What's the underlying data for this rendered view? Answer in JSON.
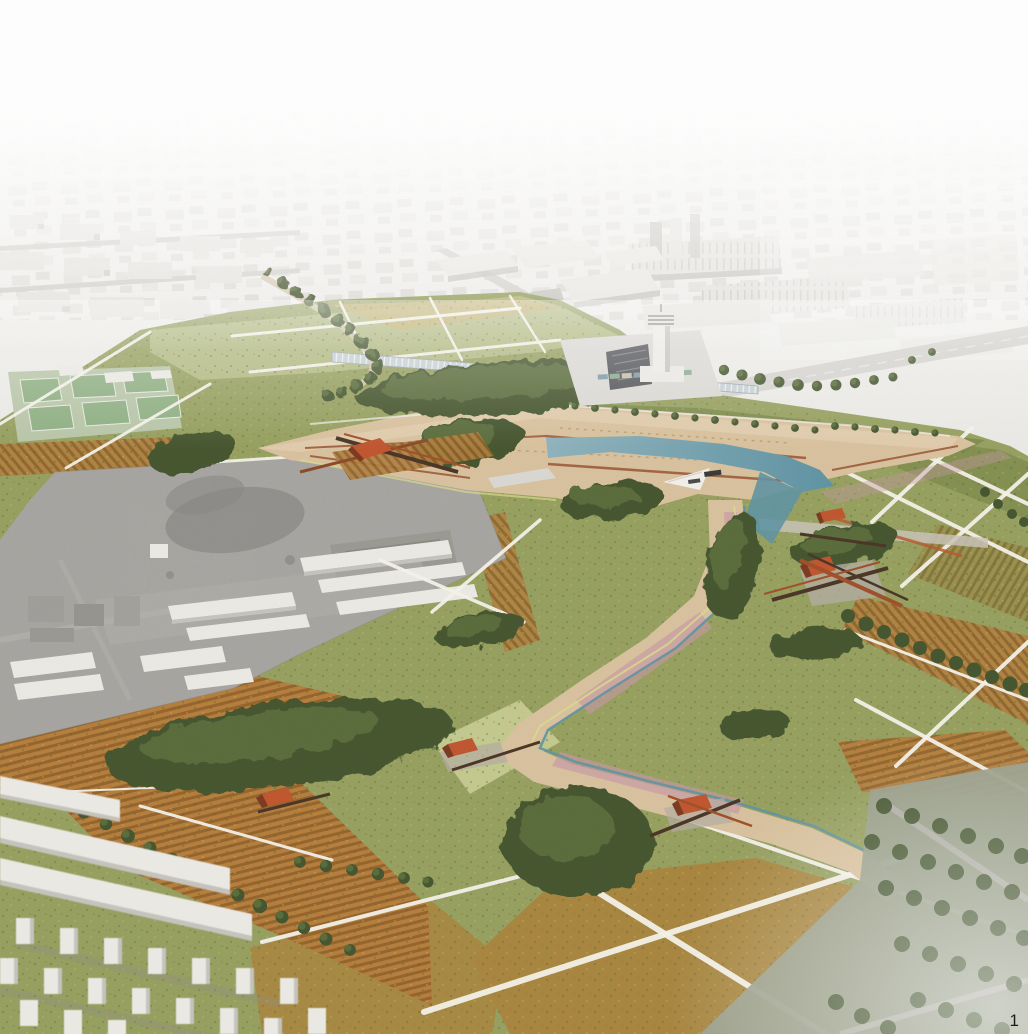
{
  "page": {
    "number": "1"
  },
  "palette": {
    "skyTop": "#fcfbfa",
    "skyHaze": "#edecE8",
    "cityBlock": "#e7e5e0",
    "cityFace": "#cbc9c4",
    "road": "#d6d4cf",
    "parkBase": "#96a05f",
    "meadowDark": "#7e8c4d",
    "meadowPale": "#b5bd85",
    "wheat": "#c3b06c",
    "fieldBrown": "#a8863f",
    "vineRowGreen": "#7f7338",
    "vineBaseGreen": "#9c8e4c",
    "vineRowBrown": "#8f6228",
    "vineBaseBrown": "#b28040",
    "vineRowOrange": "#95642c",
    "vineBaseOrange": "#b57e3c",
    "pathWhite": "#f4f2ea",
    "esplanade": "#d9c29e",
    "esplanadeLight": "#e7d6b8",
    "water": "#8fb3bd",
    "waterDark": "#5f93a3",
    "clayRed": "#9c5a38",
    "pinkPath": "#c79aa6",
    "vergeYellow": "#d9da8c",
    "treeDark": "#44552f",
    "treeMid": "#5a6c3b",
    "treeLight": "#70824a",
    "oliveGroveGround": "#9aa08c",
    "pavilionOrange": "#c0562f",
    "pavilionDark": "#7c3a20",
    "rampDark": "#4a3526",
    "rampRed": "#a14f28",
    "photoGrey": "#a6a4a0",
    "photoDark": "#7e7c78",
    "bldgWhite": "#eceae5",
    "bldgFace": "#c6c4bf",
    "courtBase": "#b9c6a8",
    "courtGreen": "#8fb083",
    "greenhouse": "#c9d2d6",
    "pageNumber": "#1d1d1b"
  }
}
